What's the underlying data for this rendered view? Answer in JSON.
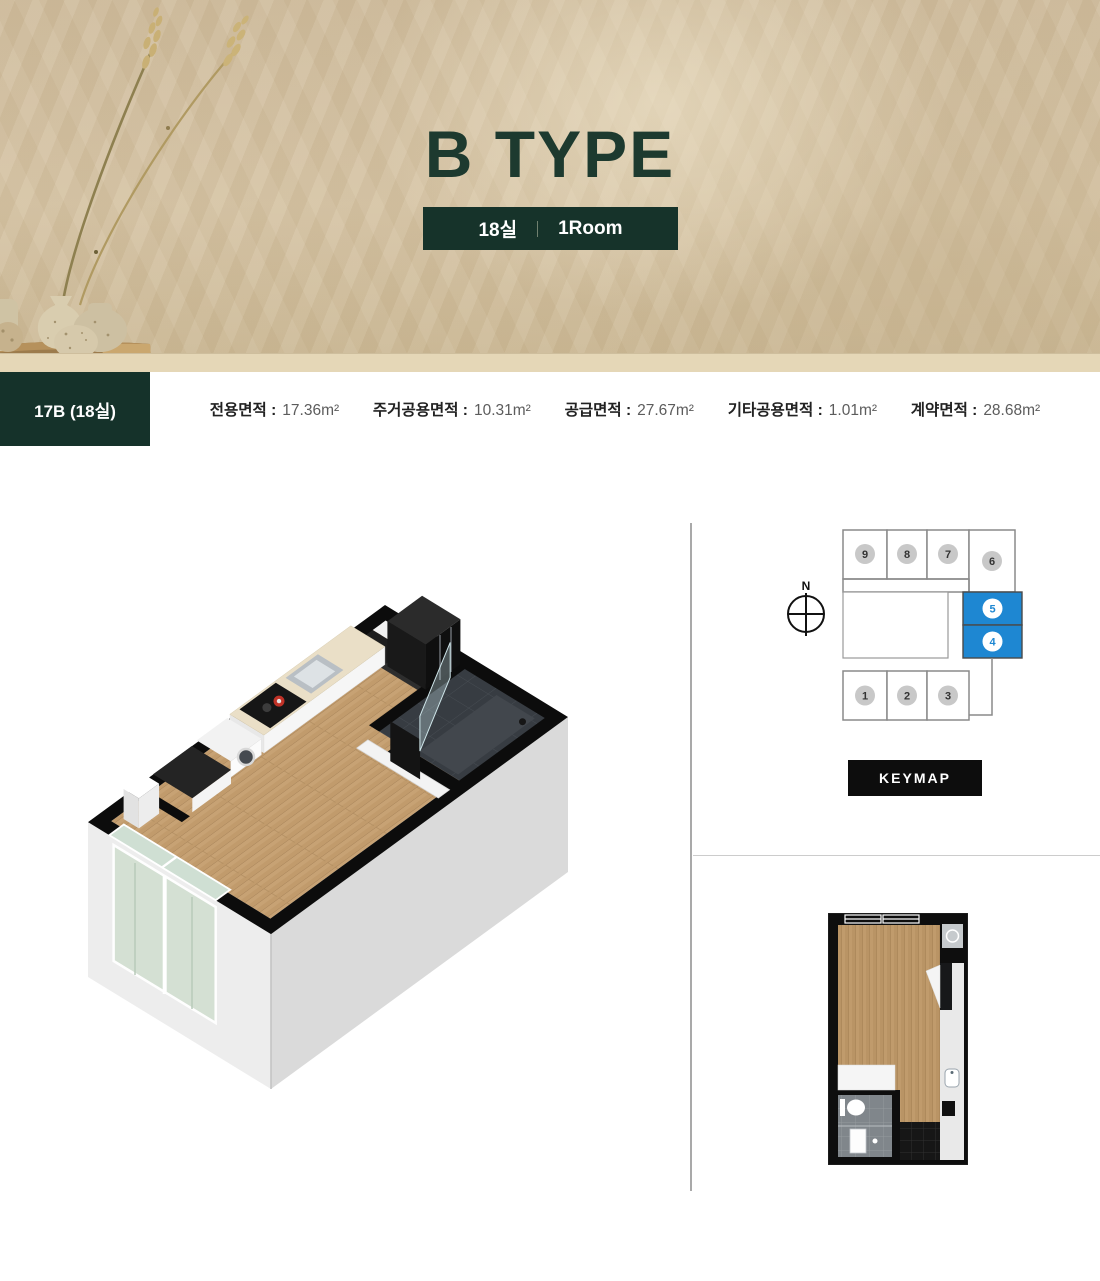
{
  "hero": {
    "title": "B TYPE",
    "badge": {
      "left": "18실",
      "right": "1Room"
    }
  },
  "spec_bar": {
    "unit_code": "17B (18실)",
    "specs": [
      {
        "label": "전용면적 :",
        "value": "17.36m²"
      },
      {
        "label": "주거공용면적 :",
        "value": "10.31m²"
      },
      {
        "label": "공급면적 :",
        "value": "27.67m²"
      },
      {
        "label": "기타공용면적 :",
        "value": "1.01m²"
      },
      {
        "label": "계약면적 :",
        "value": "28.68m²"
      }
    ]
  },
  "keymap": {
    "compass_label": "N",
    "button_label": "KEYMAP",
    "highlight_color": "#1e87d2",
    "units": [
      {
        "label": "9",
        "highlighted": false
      },
      {
        "label": "8",
        "highlighted": false
      },
      {
        "label": "7",
        "highlighted": false
      },
      {
        "label": "6",
        "highlighted": false
      },
      {
        "label": "5",
        "highlighted": true
      },
      {
        "label": "4",
        "highlighted": true
      },
      {
        "label": "1",
        "highlighted": false
      },
      {
        "label": "2",
        "highlighted": false
      },
      {
        "label": "3",
        "highlighted": false
      }
    ]
  },
  "colors": {
    "brand_green": "#16332a",
    "title_green": "#1d3a2f",
    "highlight_blue": "#1e87d2",
    "hero_beige": "#d0bd9d"
  }
}
